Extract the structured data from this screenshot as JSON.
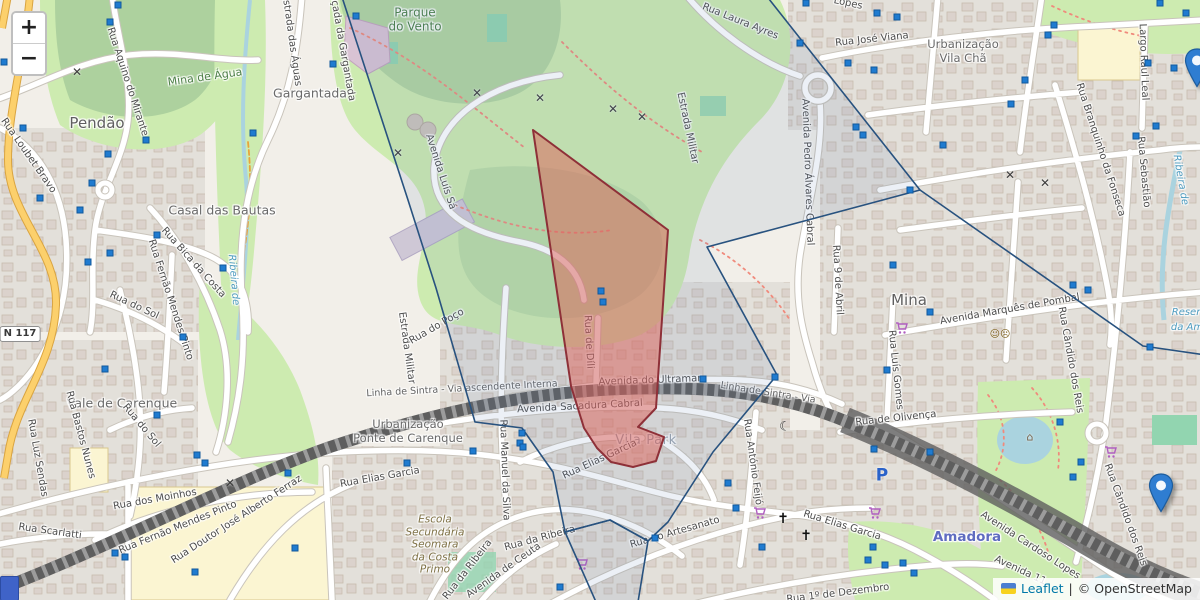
{
  "controls": {
    "zoom_in_label": "+",
    "zoom_out_label": "−"
  },
  "attribution": {
    "leaflet": "Leaflet",
    "sep": "|",
    "osm": "© OpenStreetMap"
  },
  "theme": {
    "bg": "#f2efe9",
    "residential": "#e3e0da",
    "bld": "#d9d0c9",
    "bldline": "#c3b5a5",
    "park": "#cdebb0",
    "wood": "#add19e",
    "pitch": "#92d5b0",
    "school": "#fbf5d2",
    "water": "#aad3df",
    "roadcase": "#c9c4bb",
    "road": "#ffffff",
    "primary": "#fcd06c",
    "rail": "#5e5e5e",
    "raildash": "#9c9c9c",
    "redstroke": "#8e3038",
    "redfill": "rgba(222,96,88,0.5)",
    "bluestroke": "#28527f",
    "bluefill": "rgba(100,130,180,0.12)",
    "square": "#1f7bd0",
    "squareborder": "#11589c",
    "marker": "#2f7dd1",
    "markerline": "#1d5d9e"
  },
  "map": {
    "labels": [
      {
        "t": "Pendão",
        "x": 97,
        "y": 123,
        "r": 0,
        "c": "town",
        "n": "place-label-pendao"
      },
      {
        "t": "Mina",
        "x": 909,
        "y": 300,
        "r": 0,
        "c": "town",
        "n": "place-label-mina"
      },
      {
        "t": "Gargantada",
        "x": 310,
        "y": 93,
        "r": 0,
        "c": "place",
        "n": "place-label-gargantada"
      },
      {
        "t": "Casal das Bautas",
        "x": 222,
        "y": 210,
        "r": 0,
        "c": "place",
        "n": "place-label-casal-das-bautas"
      },
      {
        "t": "Vale de Carenque",
        "x": 122,
        "y": 403,
        "r": 0,
        "c": "place",
        "n": "place-label-vale-de-carenque"
      },
      {
        "t": "Urbanização\nVila Chã",
        "x": 963,
        "y": 52,
        "r": 0,
        "c": "place2",
        "n": "place-label-urbanizacao-vila-cha"
      },
      {
        "t": "Urbanização\nPonte de Carenque",
        "x": 408,
        "y": 432,
        "r": 0,
        "c": "place2",
        "n": "place-label-ponte-de-carenque"
      },
      {
        "t": "Vila Park",
        "x": 646,
        "y": 441,
        "r": 0,
        "c": "area",
        "n": "area-label-vila-park"
      },
      {
        "t": "Amadora",
        "x": 967,
        "y": 537,
        "r": 0,
        "c": "station",
        "n": "station-label-amadora"
      },
      {
        "t": "Parque\ndo Vento",
        "x": 415,
        "y": 20,
        "r": 0,
        "c": "park2",
        "n": "park-label-parque-do-vento"
      },
      {
        "t": "Mina de Água",
        "x": 205,
        "y": 77,
        "r": -8,
        "c": "park",
        "n": "park-label-mina-de-agua"
      },
      {
        "t": "Escola\nSecundária\nSeomara\nda Costa\nPrimo",
        "x": 435,
        "y": 545,
        "r": 0,
        "c": "school",
        "n": "school-label"
      },
      {
        "t": "Reserv",
        "x": 1189,
        "y": 313,
        "r": 0,
        "c": "water",
        "n": "water-label-reserv"
      },
      {
        "t": "da Am",
        "x": 1187,
        "y": 328,
        "r": 0,
        "c": "water",
        "n": "water-label-reserv2"
      },
      {
        "t": "Ribeira de",
        "x": 1180,
        "y": 180,
        "r": 80,
        "c": "water",
        "n": "water-label-ribeira-right"
      },
      {
        "t": "Ribeira de",
        "x": 233,
        "y": 280,
        "r": 85,
        "c": "water",
        "n": "water-label-ribeira-left"
      },
      {
        "t": "Rua Laura Ayres",
        "x": 740,
        "y": 22,
        "r": 22,
        "c": "street"
      },
      {
        "t": "Lopes",
        "x": 848,
        "y": 4,
        "r": 12,
        "c": "street"
      },
      {
        "t": "Rua José Viana",
        "x": 872,
        "y": 40,
        "r": -6,
        "c": "street"
      },
      {
        "t": "Largo Raul Leal",
        "x": 1143,
        "y": 62,
        "r": 88,
        "c": "street"
      },
      {
        "t": "Rua Branquinho da Fonseca",
        "x": 1100,
        "y": 150,
        "r": 72,
        "c": "street"
      },
      {
        "t": "Rua Sebastião",
        "x": 1143,
        "y": 172,
        "r": 85,
        "c": "street"
      },
      {
        "t": "Estrada das Águas",
        "x": 291,
        "y": 40,
        "r": 82,
        "c": "street"
      },
      {
        "t": "Calçada da Gargantada",
        "x": 341,
        "y": 43,
        "r": 80,
        "c": "street"
      },
      {
        "t": "Rua Aquino do Mirante",
        "x": 127,
        "y": 82,
        "r": 72,
        "c": "street"
      },
      {
        "t": "Rua Loubet Bravo",
        "x": 28,
        "y": 156,
        "r": 55,
        "c": "street"
      },
      {
        "t": "Rua Fernão Mendes Pinto",
        "x": 170,
        "y": 300,
        "r": 72,
        "c": "street"
      },
      {
        "t": "Rua Bica da Costa",
        "x": 193,
        "y": 263,
        "r": 48,
        "c": "street"
      },
      {
        "t": "Rua do Sol",
        "x": 134,
        "y": 306,
        "r": 25,
        "c": "street"
      },
      {
        "t": "Rua do Sol",
        "x": 141,
        "y": 426,
        "r": 50,
        "c": "street"
      },
      {
        "t": "Rua Luz Sendas",
        "x": 37,
        "y": 458,
        "r": 80,
        "c": "street"
      },
      {
        "t": "Rua Bastos Nunes",
        "x": 80,
        "y": 435,
        "r": 75,
        "c": "street"
      },
      {
        "t": "Rua Scarlatti",
        "x": 50,
        "y": 532,
        "r": 8,
        "c": "street"
      },
      {
        "t": "Rua dos Moinhos",
        "x": 155,
        "y": 500,
        "r": -10,
        "c": "street"
      },
      {
        "t": "Rua Fernão Mendes Pinto",
        "x": 178,
        "y": 528,
        "r": -22,
        "c": "street"
      },
      {
        "t": "Rua Doutor José Alberto Ferraz",
        "x": 237,
        "y": 520,
        "r": -33,
        "c": "street"
      },
      {
        "t": "Estrada Militar",
        "x": 687,
        "y": 128,
        "r": 78,
        "c": "street"
      },
      {
        "t": "Estrada Militar",
        "x": 406,
        "y": 348,
        "r": 82,
        "c": "street"
      },
      {
        "t": "Avenida Pedro Álvares Cabral",
        "x": 807,
        "y": 172,
        "r": 88,
        "c": "street"
      },
      {
        "t": "Avenida Luís Sá",
        "x": 440,
        "y": 172,
        "r": 72,
        "c": "street"
      },
      {
        "t": "Rua do Poço",
        "x": 437,
        "y": 327,
        "r": -30,
        "c": "street"
      },
      {
        "t": "Linha de Sintra - Via ascendente Interna",
        "x": 462,
        "y": 389,
        "r": -3,
        "c": "rail"
      },
      {
        "t": "Linha de Sintra - Via",
        "x": 768,
        "y": 393,
        "r": 9,
        "c": "rail"
      },
      {
        "t": "Avenida do Ultramar",
        "x": 650,
        "y": 381,
        "r": -2,
        "c": "street"
      },
      {
        "t": "Avenida Sacadura Cabral",
        "x": 580,
        "y": 407,
        "r": -3,
        "c": "street"
      },
      {
        "t": "Rua de Díli",
        "x": 588,
        "y": 342,
        "r": 87,
        "c": "street"
      },
      {
        "t": "Rua Elias Garcia",
        "x": 600,
        "y": 460,
        "r": -25,
        "c": "street"
      },
      {
        "t": "Rua Elias Garcia",
        "x": 380,
        "y": 478,
        "r": -10,
        "c": "street"
      },
      {
        "t": "Rua Elias Garcia",
        "x": 842,
        "y": 526,
        "r": 17,
        "c": "street"
      },
      {
        "t": "Rua Manuel da Silva",
        "x": 504,
        "y": 470,
        "r": 88,
        "c": "street"
      },
      {
        "t": "Rua da Ribeira",
        "x": 468,
        "y": 570,
        "r": -52,
        "c": "street"
      },
      {
        "t": "Rua da Ribeira",
        "x": 540,
        "y": 539,
        "r": -15,
        "c": "street"
      },
      {
        "t": "Avenida de Ceuta",
        "x": 504,
        "y": 571,
        "r": -35,
        "c": "street"
      },
      {
        "t": "Rua do Artesanato",
        "x": 675,
        "y": 533,
        "r": -16,
        "c": "street"
      },
      {
        "t": "Rua António Feijó",
        "x": 752,
        "y": 462,
        "r": 82,
        "c": "street"
      },
      {
        "t": "Rua 1º de Dezembro",
        "x": 838,
        "y": 594,
        "r": -7,
        "c": "street"
      },
      {
        "t": "Rua 9 de Abril",
        "x": 837,
        "y": 280,
        "r": 87,
        "c": "street"
      },
      {
        "t": "Avenida Marquês de Pombal",
        "x": 1010,
        "y": 310,
        "r": -10,
        "c": "street"
      },
      {
        "t": "Rua Luís Gomes",
        "x": 895,
        "y": 370,
        "r": 84,
        "c": "street"
      },
      {
        "t": "Rua de Olivença",
        "x": 896,
        "y": 419,
        "r": -6,
        "c": "street"
      },
      {
        "t": "Rua Cândido dos Reis",
        "x": 1070,
        "y": 360,
        "r": 80,
        "c": "street"
      },
      {
        "t": "Rua Cândido dos Reis",
        "x": 1125,
        "y": 515,
        "r": 70,
        "c": "street"
      },
      {
        "t": "Avenida Cardoso Lopes",
        "x": 1030,
        "y": 546,
        "r": 33,
        "c": "street"
      },
      {
        "t": "Avenida 11",
        "x": 1020,
        "y": 571,
        "r": 25,
        "c": "street"
      }
    ],
    "road_shield": {
      "text": "N 117",
      "x": 20,
      "y": 334
    },
    "poi": {
      "types": {
        "windmill": {
          "glyph": "✕",
          "color": "#3d3d3d",
          "size": 12,
          "bold": true,
          "name": "windmill-icon"
        },
        "cross": {
          "glyph": "✝",
          "color": "#111111",
          "size": 14,
          "bold": true,
          "name": "church-cross-icon"
        },
        "crescent": {
          "glyph": "☾",
          "color": "#333333",
          "size": 13,
          "bold": true,
          "name": "mosque-crescent-icon"
        },
        "masks": {
          "glyph": "☺☹",
          "color": "#7a5c16",
          "size": 10,
          "bold": false,
          "name": "theatre-masks-icon"
        },
        "gazebo": {
          "glyph": "⌂",
          "color": "#74614a",
          "size": 11,
          "bold": false,
          "name": "gazebo-icon"
        },
        "parking": {
          "glyph": "P",
          "color": "#2a62c9",
          "size": 17,
          "bold": true,
          "name": "parking-icon"
        },
        "cart": {
          "glyph": "",
          "color": "#b05fc0",
          "size": 12,
          "bold": false,
          "name": "shopping-cart-icon",
          "svg": "cart"
        }
      },
      "items": [
        {
          "k": "windmill",
          "x": 77,
          "y": 72
        },
        {
          "k": "windmill",
          "x": 398,
          "y": 153
        },
        {
          "k": "windmill",
          "x": 477,
          "y": 93
        },
        {
          "k": "windmill",
          "x": 540,
          "y": 98
        },
        {
          "k": "windmill",
          "x": 613,
          "y": 109
        },
        {
          "k": "windmill",
          "x": 642,
          "y": 117
        },
        {
          "k": "windmill",
          "x": 230,
          "y": 483
        },
        {
          "k": "windmill",
          "x": 1010,
          "y": 175
        },
        {
          "k": "windmill",
          "x": 1045,
          "y": 183
        },
        {
          "k": "cross",
          "x": 783,
          "y": 519
        },
        {
          "k": "cross",
          "x": 806,
          "y": 536
        },
        {
          "k": "crescent",
          "x": 785,
          "y": 427
        },
        {
          "k": "masks",
          "x": 1000,
          "y": 335
        },
        {
          "k": "gazebo",
          "x": 1030,
          "y": 437
        },
        {
          "k": "parking",
          "x": 882,
          "y": 476
        },
        {
          "k": "cart",
          "x": 895,
          "y": 322
        },
        {
          "k": "cart",
          "x": 753,
          "y": 507
        },
        {
          "k": "cart",
          "x": 868,
          "y": 507
        },
        {
          "k": "cart",
          "x": 575,
          "y": 558
        },
        {
          "k": "cart",
          "x": 1104,
          "y": 446
        }
      ]
    },
    "blue_squares": [
      [
        118,
        5
      ],
      [
        110,
        22
      ],
      [
        4,
        62
      ],
      [
        23,
        128
      ],
      [
        146,
        140
      ],
      [
        108,
        154
      ],
      [
        92,
        183
      ],
      [
        40,
        198
      ],
      [
        80,
        210
      ],
      [
        110,
        253
      ],
      [
        88,
        262
      ],
      [
        157,
        235
      ],
      [
        223,
        268
      ],
      [
        253,
        133
      ],
      [
        105,
        369
      ],
      [
        183,
        337
      ],
      [
        157,
        415
      ],
      [
        197,
        455
      ],
      [
        205,
        463
      ],
      [
        115,
        553
      ],
      [
        125,
        557
      ],
      [
        195,
        572
      ],
      [
        295,
        548
      ],
      [
        288,
        473
      ],
      [
        356,
        16
      ],
      [
        333,
        64
      ],
      [
        407,
        463
      ],
      [
        473,
        451
      ],
      [
        520,
        443
      ],
      [
        560,
        587
      ],
      [
        601,
        291
      ],
      [
        603,
        302
      ],
      [
        522,
        433
      ],
      [
        523,
        447
      ],
      [
        655,
        538
      ],
      [
        703,
        379
      ],
      [
        775,
        377
      ],
      [
        728,
        483
      ],
      [
        736,
        508
      ],
      [
        762,
        547
      ],
      [
        874,
        449
      ],
      [
        930,
        452
      ],
      [
        868,
        560
      ],
      [
        885,
        565
      ],
      [
        893,
        265
      ],
      [
        930,
        312
      ],
      [
        887,
        370
      ],
      [
        1073,
        285
      ],
      [
        1088,
        290
      ],
      [
        1150,
        347
      ],
      [
        1060,
        422
      ],
      [
        1081,
        462
      ],
      [
        1073,
        477
      ],
      [
        873,
        547
      ],
      [
        903,
        563
      ],
      [
        914,
        573
      ],
      [
        1186,
        13
      ],
      [
        1160,
        3
      ],
      [
        1054,
        25
      ],
      [
        1048,
        35
      ],
      [
        1148,
        63
      ],
      [
        1174,
        68
      ],
      [
        1025,
        80
      ],
      [
        1011,
        104
      ],
      [
        943,
        145
      ],
      [
        1156,
        126
      ],
      [
        1136,
        136
      ],
      [
        910,
        190
      ],
      [
        806,
        3
      ],
      [
        877,
        13
      ],
      [
        897,
        17
      ],
      [
        800,
        43
      ],
      [
        848,
        63
      ],
      [
        874,
        70
      ],
      [
        856,
        127
      ],
      [
        863,
        135
      ]
    ],
    "markers": [
      {
        "x": 1161,
        "y": 512,
        "name": "map-marker-pin"
      },
      {
        "x": 1197,
        "y": 87,
        "name": "map-marker-pin-edge"
      }
    ],
    "blue_shield": {
      "x": 0,
      "y": 576,
      "w": 17,
      "h": 23
    }
  }
}
